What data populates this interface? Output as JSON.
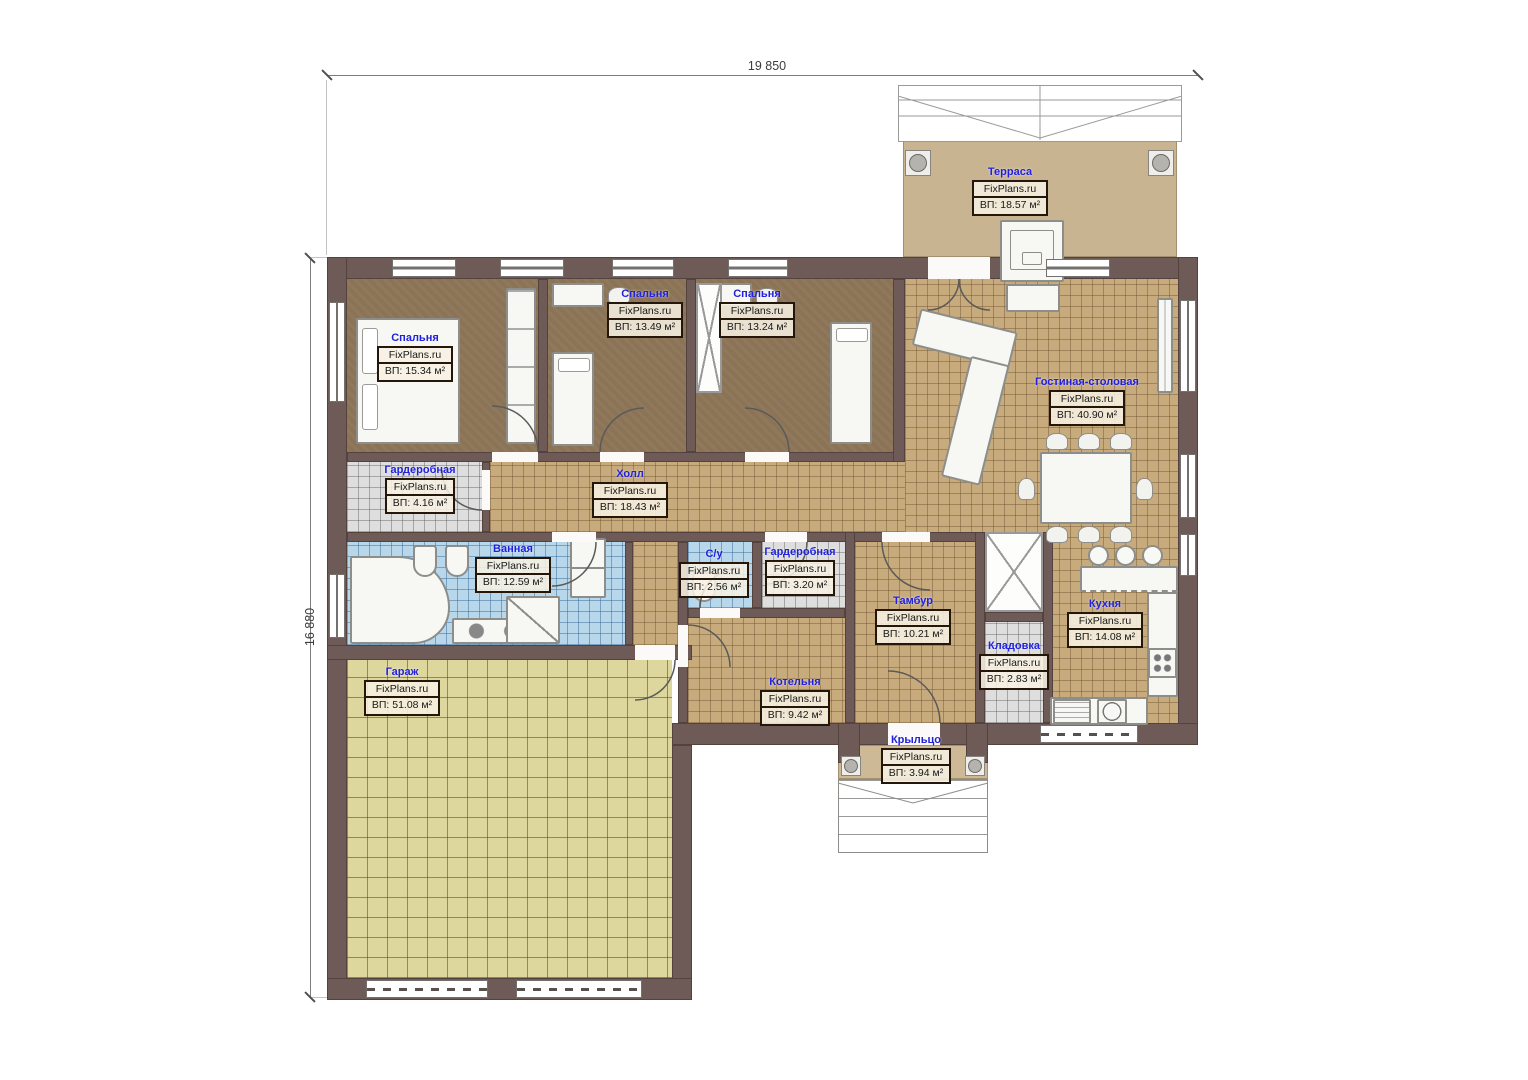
{
  "brand": "FixPlans.ru",
  "dimensions": {
    "top": "19 850",
    "left": "16 880"
  },
  "rooms": [
    {
      "name": "Терраса",
      "area": "ВП: 18.57 м²"
    },
    {
      "name": "Спальня",
      "area": "ВП: 15.34 м²"
    },
    {
      "name": "Спальня",
      "area": "ВП: 13.49 м²"
    },
    {
      "name": "Спальня",
      "area": "ВП: 13.24 м²"
    },
    {
      "name": "Гостиная-столовая",
      "area": "ВП: 40.90 м²"
    },
    {
      "name": "Гардеробная",
      "area": "ВП: 4.16 м²"
    },
    {
      "name": "Холл",
      "area": "ВП: 18.43 м²"
    },
    {
      "name": "Ванная",
      "area": "ВП: 12.59 м²"
    },
    {
      "name": "С/у",
      "area": "ВП: 2.56 м²"
    },
    {
      "name": "Гардеробная",
      "area": "ВП: 3.20 м²"
    },
    {
      "name": "Тамбур",
      "area": "ВП: 10.21 м²"
    },
    {
      "name": "Кухня",
      "area": "ВП: 14.08 м²"
    },
    {
      "name": "Кладовка",
      "area": "ВП: 2.83 м²"
    },
    {
      "name": "Котельня",
      "area": "ВП: 9.42 м²"
    },
    {
      "name": "Гараж",
      "area": "ВП: 51.08 м²"
    },
    {
      "name": "Крыльцо",
      "area": "ВП: 3.94 м²"
    }
  ],
  "colors": {
    "wall": "#6e5a57",
    "floor_bedroom": "#8b7356",
    "floor_tile": "#c8ab7c",
    "floor_bath": "#b9d7ea",
    "floor_wardrobe": "#dedede",
    "floor_garage": "#ddd79e",
    "floor_terrace": "#c9b492",
    "label_name": "#2121dd"
  }
}
